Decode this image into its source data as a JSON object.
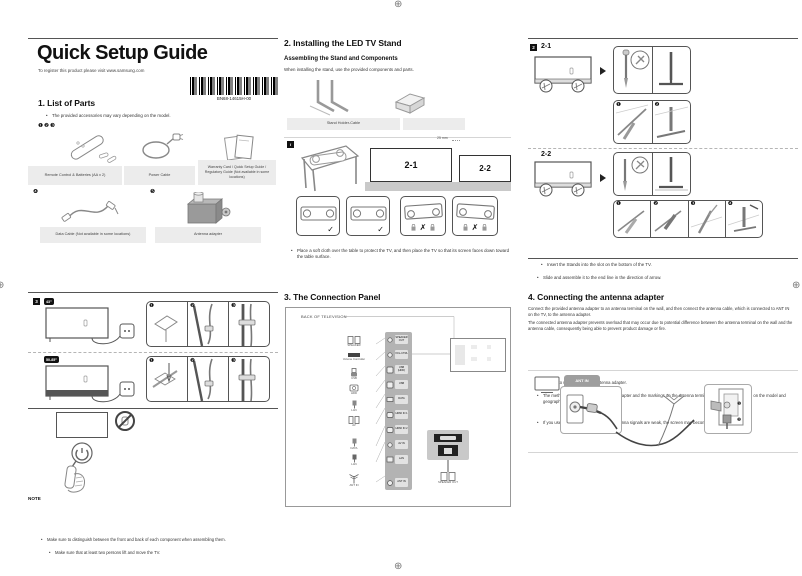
{
  "page": {
    "title": "Quick Setup Guide",
    "subtitle": "To register this product please visit www.samsung.com",
    "barcode_label": "BN68-14615H-00"
  },
  "parts": {
    "heading": "1. List of Parts",
    "bullet": "The provided accessories may vary depending on the model.",
    "numbers_row1": "❶❷❸",
    "number4": "❹",
    "number5": "❺",
    "items": [
      {
        "label": "Remote Control & Batteries (AA x 2)"
      },
      {
        "label": "Power Cable"
      },
      {
        "label": "Warranty Card / Quick Setup Guide / Regulatory Guide (Not available in some locations)"
      },
      {
        "label": "Data Cable (Not available in some locations)"
      },
      {
        "label": "Antenna adapter"
      }
    ]
  },
  "stand": {
    "heading": "2. Installing the LED TV Stand",
    "subheading": "Assembling the Stand and Components",
    "intro": "When installing the stand, use the provided components and parts.",
    "stand_label": "Stand Holder-Cable",
    "info_icon": "i",
    "tv_left": "2-1",
    "tv_right": "2-2",
    "gap": "25 mm",
    "check": "✓",
    "cross": "✗",
    "bullet": "Place a soft cloth over the table to protect the TV, and then place the TV so that its screen faces down toward the table surface."
  },
  "stand_steps": {
    "section_number": "2",
    "variant1": "2-1",
    "variant2": "2-2",
    "s1": "❶",
    "s2": "❷",
    "s3": "❸",
    "s4": "❹",
    "bullets": [
      "Insert the Stands into the slot on the bottom of the TV.",
      "Slide and assemble it to the end line in the direction of arrow."
    ]
  },
  "cables": {
    "section_number": "3",
    "size1": "43″",
    "size2": "50-85″",
    "s1": "❶",
    "s2": "❷",
    "s3": "❸",
    "note_label": "NOTE",
    "note_bullets": [
      "Make sure to distinguish between the front and back of each component when assembling them.",
      "Make sure that at least two persons lift and move the TV."
    ]
  },
  "connection": {
    "heading": "3. The Connection Panel",
    "back_label": "BACK OF TELEVISION",
    "jacks": [
      {
        "label": "SPEAKER"
      },
      {
        "label": "Volume Controller"
      },
      {
        "label": "USB"
      },
      {
        "label": "HDD"
      },
      {
        "label": "LAN"
      },
      {
        "label": "AV"
      },
      {
        "label": "DATA"
      },
      {
        "label": "LAN"
      },
      {
        "label": "ANT IN"
      }
    ],
    "ports": [
      {
        "label": "SPEAKER OUT"
      },
      {
        "label": "VOL-CTRL"
      },
      {
        "label": "USB (HDD)"
      },
      {
        "label": "USB"
      },
      {
        "label": "DATA"
      },
      {
        "label": "HDMI IN 1"
      },
      {
        "label": "HDMI IN 2"
      },
      {
        "label": "AV IN"
      },
      {
        "label": "LAN"
      },
      {
        "label": "ANT IN"
      }
    ],
    "inset_label": "SPEAKER OUT"
  },
  "antenna": {
    "heading": "4. Connecting the antenna adapter",
    "p1": "Connect the provided antenna adapter to an antenna terminal on the wall, and then connect the antenna cable, which is connected to ANT IN on the TV, to the antenna adapter.",
    "p2": "The connected antenna adapter prevents overload that may occur due to potential difference between the antenna terminal on the wall and the antenna cable, consequently being able to prevent product damage or fire.",
    "bullets": [
      "Be sure to use the provided antenna adapter.",
      "The method for connecting the antenna adapter and the markings on the antenna terminals may differ depending on the model and geographical region.",
      "If you use the antenna adapter where antenna signals are weak, the screen may become blurry."
    ],
    "port_tab": "ANT IN",
    "step1": "❶",
    "step2": "❷"
  }
}
